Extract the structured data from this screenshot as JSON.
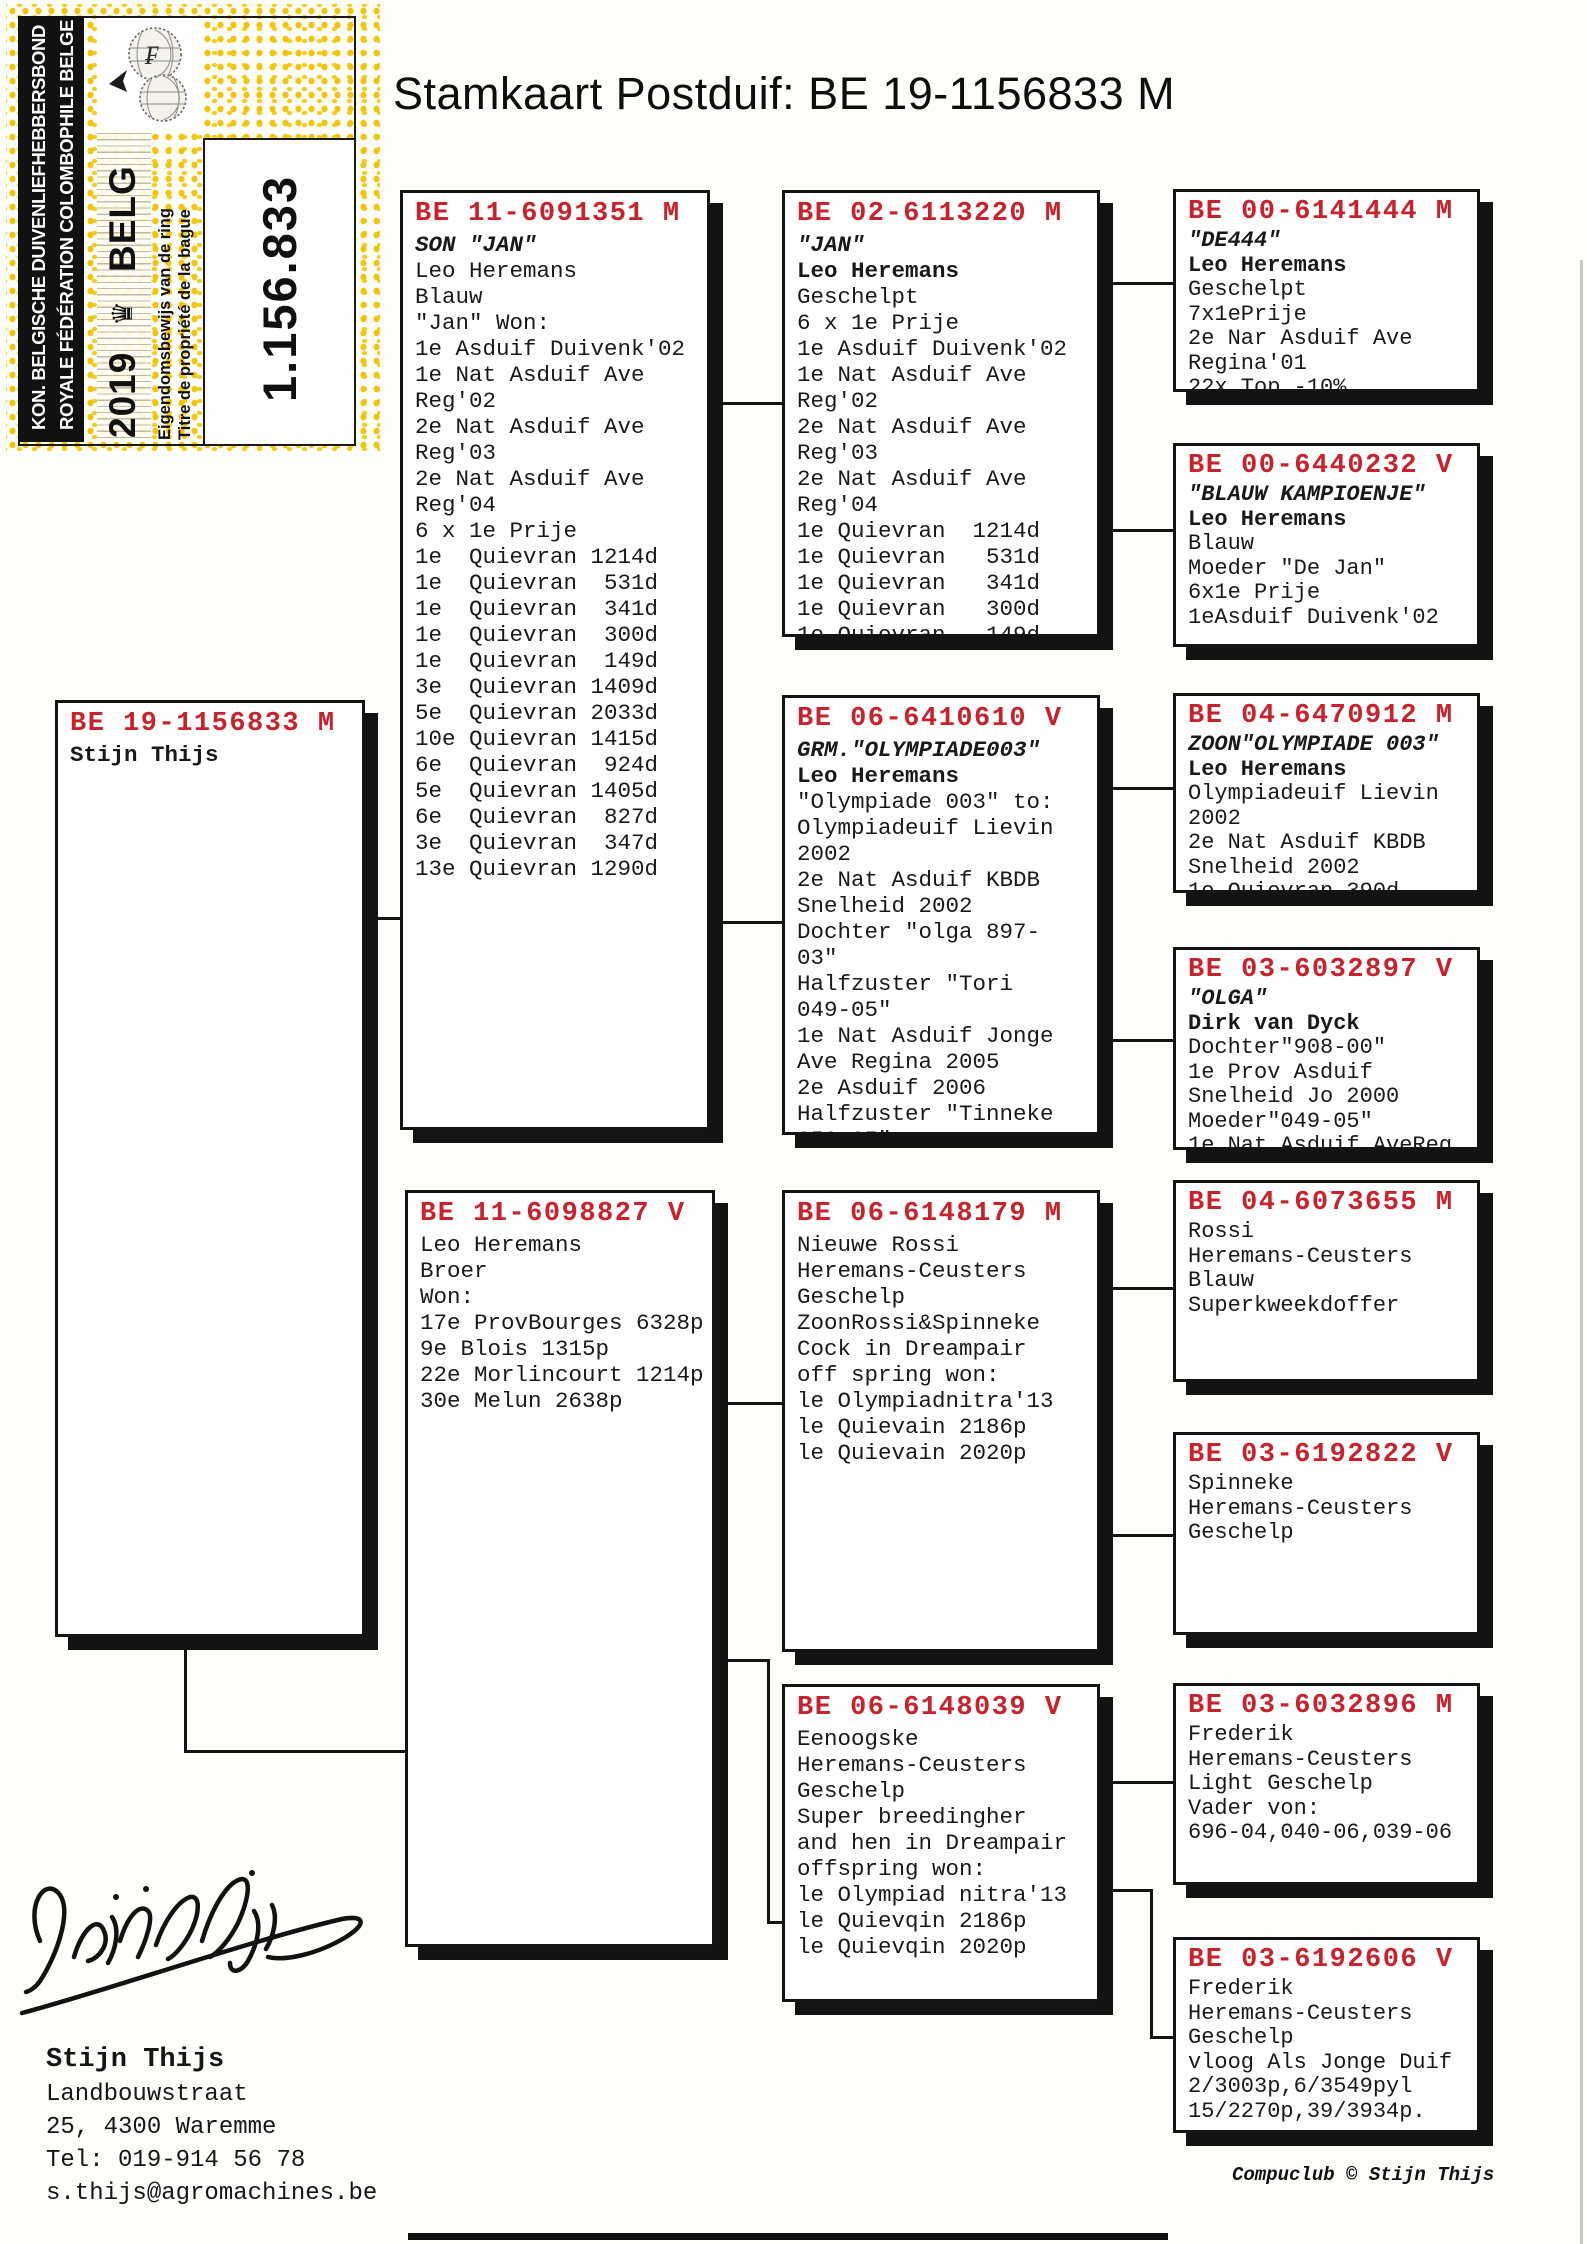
{
  "title": "Stamkaart Postduif: BE 19-1156833 M",
  "colors": {
    "ring_red": "#c8232c",
    "stamp_yellow": "#f2c40b"
  },
  "stamp": {
    "federation_line1": "KON. BELGISCHE DUIVENLIEFHEBBERSBOND",
    "federation_line2": "ROYALE FÉDÉRATION COLOMBOPHILE BELGE",
    "year": "2019",
    "country": "BELG",
    "crown": "♛",
    "ownership_nl": "Eigendomsbewijs van de ring",
    "ownership_fr": "Titre de propriété de la bague",
    "ring_number": "1.156.833"
  },
  "boxes": [
    {
      "ring": "BE 19-1156833 M",
      "lines": [
        {
          "t": "Stijn Thijs",
          "b": true
        }
      ]
    },
    {
      "ring": "BE 11-6091351 M",
      "lines": [
        {
          "t": "SON \"JAN\"",
          "i": true
        },
        {
          "t": "Leo Heremans"
        },
        {
          "t": "Blauw"
        },
        {
          "t": "\"Jan\" Won:"
        },
        {
          "t": "1e Asduif Duivenk'02"
        },
        {
          "t": "1e Nat Asduif Ave"
        },
        {
          "t": "Reg'02"
        },
        {
          "t": "2e Nat Asduif Ave"
        },
        {
          "t": "Reg'03"
        },
        {
          "t": "2e Nat Asduif Ave"
        },
        {
          "t": "Reg'04"
        },
        {
          "t": "6 x 1e Prije"
        },
        {
          "t": "1e  Quievran 1214d"
        },
        {
          "t": "1e  Quievran  531d"
        },
        {
          "t": "1e  Quievran  341d"
        },
        {
          "t": "1e  Quievran  300d"
        },
        {
          "t": "1e  Quievran  149d"
        },
        {
          "t": "3e  Quievran 1409d"
        },
        {
          "t": "5e  Quievran 2033d"
        },
        {
          "t": "10e Quievran 1415d"
        },
        {
          "t": "6e  Quievran  924d"
        },
        {
          "t": "5e  Quievran 1405d"
        },
        {
          "t": "6e  Quievran  827d"
        },
        {
          "t": "3e  Quievran  347d"
        },
        {
          "t": "13e Quievran 1290d"
        }
      ]
    },
    {
      "ring": "BE 11-6098827 V",
      "lines": [
        {
          "t": "Leo Heremans"
        },
        {
          "t": "Broer"
        },
        {
          "t": "Won:"
        },
        {
          "t": "17e ProvBourges 6328p"
        },
        {
          "t": "9e Blois 1315p"
        },
        {
          "t": "22e Morlincourt 1214p"
        },
        {
          "t": "30e Melun 2638p"
        }
      ]
    },
    {
      "ring": "BE 02-6113220 M",
      "lines": [
        {
          "t": "\"JAN\"",
          "i": true
        },
        {
          "t": "Leo Heremans",
          "b": true
        },
        {
          "t": "Geschelpt"
        },
        {
          "t": "6 x 1e Prije"
        },
        {
          "t": "1e Asduif Duivenk'02"
        },
        {
          "t": "1e Nat Asduif Ave"
        },
        {
          "t": "Reg'02"
        },
        {
          "t": "2e Nat Asduif Ave"
        },
        {
          "t": "Reg'03"
        },
        {
          "t": "2e Nat Asduif Ave"
        },
        {
          "t": "Reg'04"
        },
        {
          "t": "1e Quievran  1214d"
        },
        {
          "t": "1e Quievran   531d"
        },
        {
          "t": "1e Quievran   341d"
        },
        {
          "t": "1e Quievran   300d"
        },
        {
          "t": "1e Quievran   149d"
        }
      ]
    },
    {
      "ring": "BE 06-6410610 V",
      "lines": [
        {
          "t": "GRM.\"OLYMPIADE003\"",
          "i": true
        },
        {
          "t": "Leo Heremans",
          "b": true
        },
        {
          "t": "\"Olympiade 003\" to:"
        },
        {
          "t": "Olympiadeuif Lievin"
        },
        {
          "t": "2002"
        },
        {
          "t": "2e Nat Asduif KBDB"
        },
        {
          "t": "Snelheid 2002"
        },
        {
          "t": "Dochter \"olga 897-"
        },
        {
          "t": "03\""
        },
        {
          "t": "Halfzuster \"Tori"
        },
        {
          "t": "049-05\""
        },
        {
          "t": "1e Nat Asduif Jonge"
        },
        {
          "t": "Ave Regina 2005"
        },
        {
          "t": "2e Asduif 2006"
        },
        {
          "t": "Halfzuster \"Tinneke"
        },
        {
          "t": "050-05\""
        }
      ]
    },
    {
      "ring": "BE 06-6148179 M",
      "lines": [
        {
          "t": "Nieuwe Rossi"
        },
        {
          "t": "Heremans-Ceusters"
        },
        {
          "t": "Geschelp"
        },
        {
          "t": "ZoonRossi&Spinneke"
        },
        {
          "t": "Cock in Dreampair"
        },
        {
          "t": "off spring won:"
        },
        {
          "t": "le Olympiadnitra'13"
        },
        {
          "t": "le Quievain 2186p"
        },
        {
          "t": "le Quievain 2020p"
        }
      ]
    },
    {
      "ring": "BE 06-6148039 V",
      "lines": [
        {
          "t": "Eenoogske"
        },
        {
          "t": "Heremans-Ceusters"
        },
        {
          "t": "Geschelp"
        },
        {
          "t": "Super breedingher"
        },
        {
          "t": "and hen in Dreampair"
        },
        {
          "t": "offspring won:"
        },
        {
          "t": "le Olympiad nitra'13"
        },
        {
          "t": "le Quievqin 2186p"
        },
        {
          "t": "le Quievqin 2020p"
        }
      ]
    },
    {
      "ring": "BE 00-6141444 M",
      "lines": [
        {
          "t": "\"DE444\"",
          "i": true
        },
        {
          "t": "Leo Heremans",
          "b": true
        },
        {
          "t": "Geschelpt"
        },
        {
          "t": "7x1ePrije"
        },
        {
          "t": "2e Nar Asduif Ave"
        },
        {
          "t": "Regina'01"
        },
        {
          "t": "22x Top -10%"
        }
      ]
    },
    {
      "ring": "BE 00-6440232 V",
      "lines": [
        {
          "t": "\"BLAUW KAMPIOENJE\"",
          "i": true
        },
        {
          "t": "Leo Heremans",
          "b": true
        },
        {
          "t": "Blauw"
        },
        {
          "t": "Moeder \"De Jan\""
        },
        {
          "t": "6x1e Prije"
        },
        {
          "t": "1eAsduif Duivenk'02"
        }
      ]
    },
    {
      "ring": "BE 04-6470912 M",
      "lines": [
        {
          "t": "ZOON\"OLYMPIADE 003\"",
          "i": true
        },
        {
          "t": "Leo Heremans",
          "b": true
        },
        {
          "t": "Olympiadeuif Lievin"
        },
        {
          "t": "2002"
        },
        {
          "t": "2e Nat Asduif KBDB"
        },
        {
          "t": "Snelheid 2002"
        },
        {
          "t": "1e Quievran 390d"
        }
      ]
    },
    {
      "ring": "BE 03-6032897 V",
      "lines": [
        {
          "t": "\"OLGA\"",
          "i": true
        },
        {
          "t": "Dirk van Dyck",
          "b": true
        },
        {
          "t": "Dochter\"908-00\""
        },
        {
          "t": "1e Prov Asduif"
        },
        {
          "t": "Snelheid Jo 2000"
        },
        {
          "t": "Moeder\"049-05\""
        },
        {
          "t": "1e Nat Asduif AveReg"
        }
      ]
    },
    {
      "ring": "BE 04-6073655 M",
      "lines": [
        {
          "t": "Rossi"
        },
        {
          "t": "Heremans-Ceusters"
        },
        {
          "t": "Blauw"
        },
        {
          "t": "Superkweekdoffer"
        }
      ]
    },
    {
      "ring": "BE 03-6192822 V",
      "lines": [
        {
          "t": "Spinneke"
        },
        {
          "t": "Heremans-Ceusters"
        },
        {
          "t": "Geschelp"
        }
      ]
    },
    {
      "ring": "BE 03-6032896 M",
      "lines": [
        {
          "t": "Frederik"
        },
        {
          "t": "Heremans-Ceusters"
        },
        {
          "t": "Light Geschelp"
        },
        {
          "t": "Vader von:"
        },
        {
          "t": "696-04,040-06,039-06"
        }
      ]
    },
    {
      "ring": "BE 03-6192606 V",
      "lines": [
        {
          "t": "Frederik"
        },
        {
          "t": "Heremans-Ceusters"
        },
        {
          "t": "Geschelp"
        },
        {
          "t": "vloog Als Jonge Duif"
        },
        {
          "t": "2/3003p,6/3549pyl"
        },
        {
          "t": "15/2270p,39/3934p."
        }
      ]
    }
  ],
  "footer": {
    "owner_name": "Stijn Thijs",
    "address_line1": "Landbouwstraat",
    "address_line2": "25, 4300 Waremme",
    "phone": "Tel: 019-914 56 78",
    "email": "s.thijs@agromachines.be",
    "credit": "Compuclub © Stijn Thijs"
  }
}
